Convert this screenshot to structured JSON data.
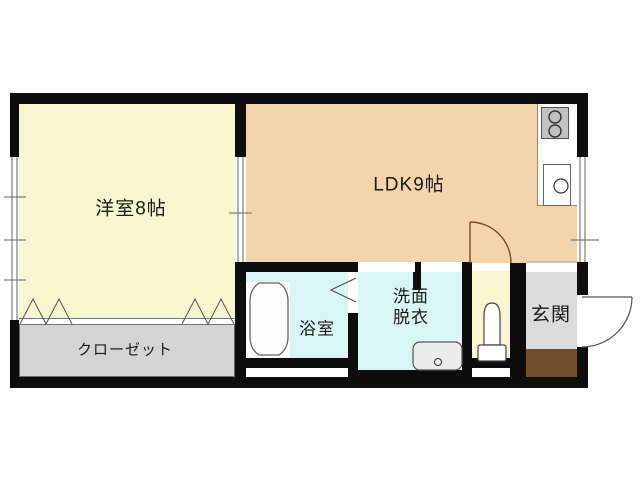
{
  "title": "1LDK apartment floor plan",
  "colors": {
    "wall": "#0D0D0D",
    "western": "#FAF6D0",
    "ldk": "#F2D5AB",
    "closet": "#D4D4D4",
    "bath": "#D9F6F7",
    "wash": "#D9F6F7",
    "toilet_room": "#FAF6D0",
    "genkan": "#DCDCDC",
    "step": "#6F4E2E",
    "door_arc": "#7B4A2A"
  },
  "rooms": {
    "western": {
      "label": "洋室8帖"
    },
    "ldk": {
      "label": "LDK9帖"
    },
    "closet": {
      "label": "クローゼット"
    },
    "bath": {
      "label": "浴室"
    },
    "wash": {
      "line1": "洗面",
      "line2": "脱衣"
    },
    "genkan": {
      "label": "玄関"
    }
  },
  "fixtures": {
    "bathtub": "bathtub-icon",
    "toilet": "toilet-icon",
    "stove": "stove-burners-icon",
    "kitchen_sink": "kitchen-sink-icon",
    "washbasin": "washbasin-icon"
  }
}
